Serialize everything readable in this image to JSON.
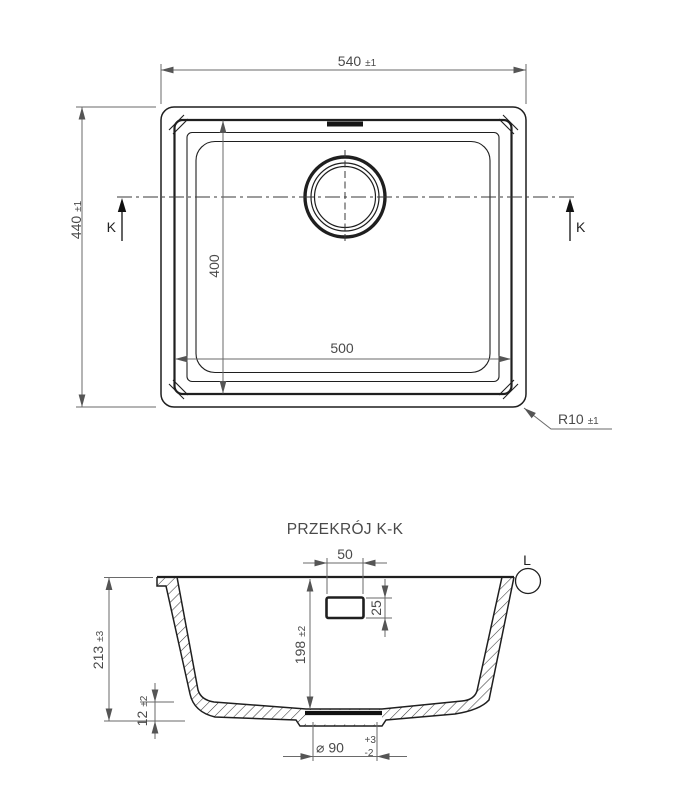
{
  "drawing": {
    "top_view": {
      "width_dim": {
        "value": "540",
        "tol": "±1"
      },
      "height_dim": {
        "value": "440",
        "tol": "±1"
      },
      "bowl_width_dim": {
        "value": "500"
      },
      "bowl_height_dim": {
        "value": "400"
      },
      "radius_dim": {
        "value": "R10",
        "tol": "±1"
      },
      "section_label_left": "K",
      "section_label_right": "K"
    },
    "section_view": {
      "title": "PRZEKRÓJ K-K",
      "detail_label": "L",
      "total_depth_dim": {
        "value": "213",
        "tol": "±3"
      },
      "bowl_depth_dim": {
        "value": "198",
        "tol": "±2"
      },
      "base_thickness_dim": {
        "value": "12",
        "tol": "±2"
      },
      "overflow_width_dim": {
        "value": "50"
      },
      "overflow_height_dim": {
        "value": "25"
      },
      "drain_dim": {
        "value": "⌀ 90",
        "tol_plus": "+3",
        "tol_minus": "-2"
      }
    }
  }
}
